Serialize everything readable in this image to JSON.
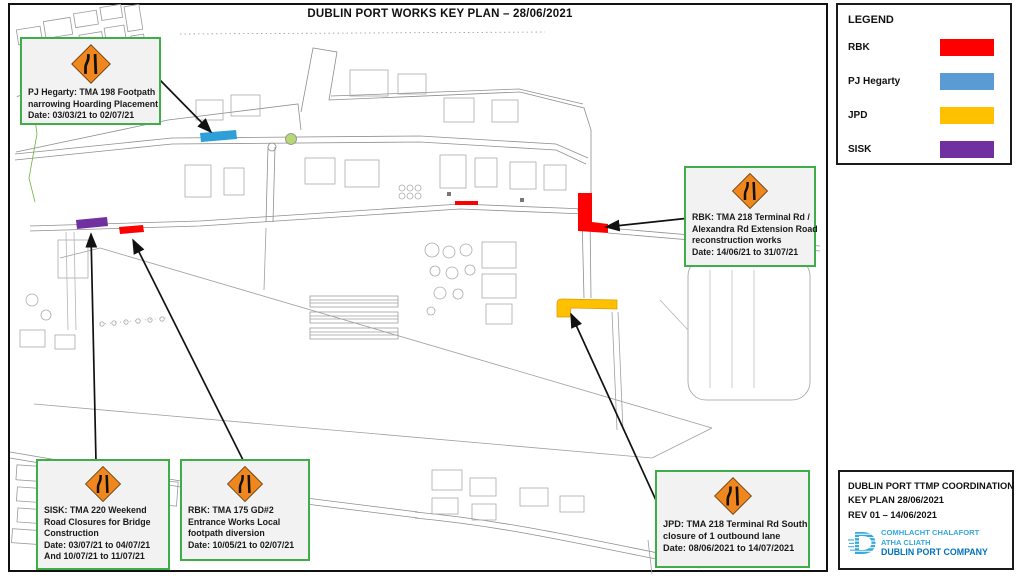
{
  "page_title": "DUBLIN PORT WORKS KEY PLAN – 28/06/2021",
  "colors": {
    "rbk": "#FF0000",
    "pj_hegarty_bar": "#2E9FD9",
    "jpd": "#FFC000",
    "sisk": "#7030A0",
    "sign_orange": "#F0861E",
    "callout_border": "#3FAE49",
    "roundabout_green": "#B8D878",
    "logo_light_blue": "#35A8DC",
    "logo_dark_blue": "#0072BC"
  },
  "legend": {
    "heading": "LEGEND",
    "items": [
      {
        "label": "RBK",
        "color": "#FF0000"
      },
      {
        "label": "PJ Hegarty",
        "color": "#5B9BD5"
      },
      {
        "label": "JPD",
        "color": "#FFC000"
      },
      {
        "label": "SISK",
        "color": "#7030A0"
      }
    ]
  },
  "callouts": [
    {
      "name": "pj-hegarty-tma-198",
      "lines": [
        "PJ Hegarty: TMA 198 Footpath",
        "narrowing Hoarding Placement",
        "Date: 03/03/21 to 02/07/21"
      ]
    },
    {
      "name": "rbk-tma-218",
      "lines": [
        "RBK: TMA 218 Terminal Rd /",
        "Alexandra Rd Extension Road",
        "reconstruction works",
        "Date: 14/06/21 to 31/07/21"
      ]
    },
    {
      "name": "sisk-tma-220",
      "lines": [
        "SISK: TMA 220 Weekend",
        "Road Closures for Bridge",
        "Construction",
        "Date: 03/07/21 to 04/07/21",
        "And  10/07/21 to 11/07/21"
      ]
    },
    {
      "name": "rbk-tma-175",
      "lines": [
        "RBK: TMA 175 GD#2",
        "Entrance Works Local",
        "footpath diversion",
        "Date: 10/05/21 to 02/07/21"
      ]
    },
    {
      "name": "jpd-tma-218",
      "lines": [
        "JPD: TMA 218 Terminal Rd South",
        "closure of 1 outbound lane",
        "Date: 08/06/2021 to 14/07/2021"
      ]
    }
  ],
  "title_block": {
    "line1": "DUBLIN PORT TTMP COORDINATION",
    "line2": "KEY PLAN  28/06/2021",
    "line3": "REV 01 – 14/06/2021",
    "logo": {
      "irish_line1": "COMHLACHT CHALAFORT",
      "irish_line2": "ATHA CLIATH",
      "english": "DUBLIN PORT COMPANY"
    }
  }
}
